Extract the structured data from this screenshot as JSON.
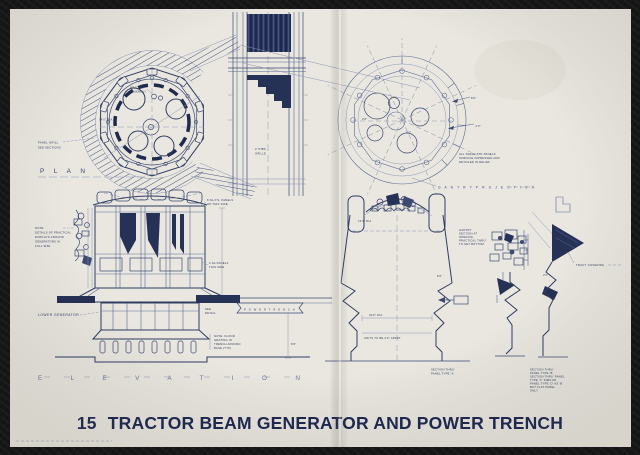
{
  "title": {
    "num": "15",
    "name": "TRACTOR BEAM GENERATOR AND POWER TRENCH"
  },
  "colors": {
    "paper": "#e9e7e0",
    "ink": "#2e3a5c",
    "ink_dark": "#263156",
    "photo_bg": "#141414"
  },
  "plan": {
    "label": "P L A N",
    "panel_note": [
      "PANEL INFILL",
      "SEE SECTIONS"
    ],
    "bracket_note": [
      "BRACKET",
      "ASSEMBLY"
    ],
    "dia": "34'0\" DIA"
  },
  "trench": {
    "grille": [
      "2' RIBS",
      "GRILLE"
    ],
    "power_label": "P O W E R   T R E N C H"
  },
  "gantry": {
    "label": "G A N T R Y    P R O J E C T I O N",
    "note": [
      "ALL THESE STR PANELS",
      "SURFACE IMPRESSED AND",
      "DETAILED IN RELIEF"
    ],
    "dim1": "8'0\"",
    "dim2": "2'0\"",
    "dim3": "3'6\"",
    "dim4": "4'0\""
  },
  "elev": {
    "label": "E L E V A T I O N",
    "lower": "LOWER GENERATOR",
    "note": [
      "NOTE:",
      "DETAILS OF PRACTICAL",
      "DISPLAYS AROUND",
      "GENERATORS IN",
      "FULL SIZE"
    ],
    "floor_note": [
      "NOTE: FLOOR",
      "GRATING IN",
      "TRENCH AROUND",
      "BASE (TYP)"
    ],
    "see_detail": [
      "SEE",
      "DETAIL"
    ],
    "panels": [
      "8 No P.S. PANELS",
      "ON THIS SIDE"
    ],
    "side": [
      "4 No PANELS",
      "THIS SIDE"
    ],
    "dim": "8'6\""
  },
  "relev": {
    "dia": "21'6\" DIA",
    "width": "40'0\" DIA",
    "units": "UNITS TO BE 2'6\" APART",
    "h": "8'6\"",
    "gantry_note": [
      "GANTRY",
      "SECTION AT",
      "OPENING",
      "PRACTICAL THRU'",
      "TO SET BOTTOM"
    ]
  },
  "sections": {
    "a": [
      "SECTION THRU'",
      "PANEL TYPE 'A'"
    ],
    "b": [
      "SECTION THRU'",
      "PANEL TYPE 'B'",
      "SECTION THRU' PANEL",
      "TYPE 'C' SIMILAR",
      "PANEL TYPE 'D' AS 'B'",
      "BUT FLAT PANEL",
      "ONLY"
    ],
    "tract": "TRACT. COVERING",
    "dim": "2'6\""
  }
}
